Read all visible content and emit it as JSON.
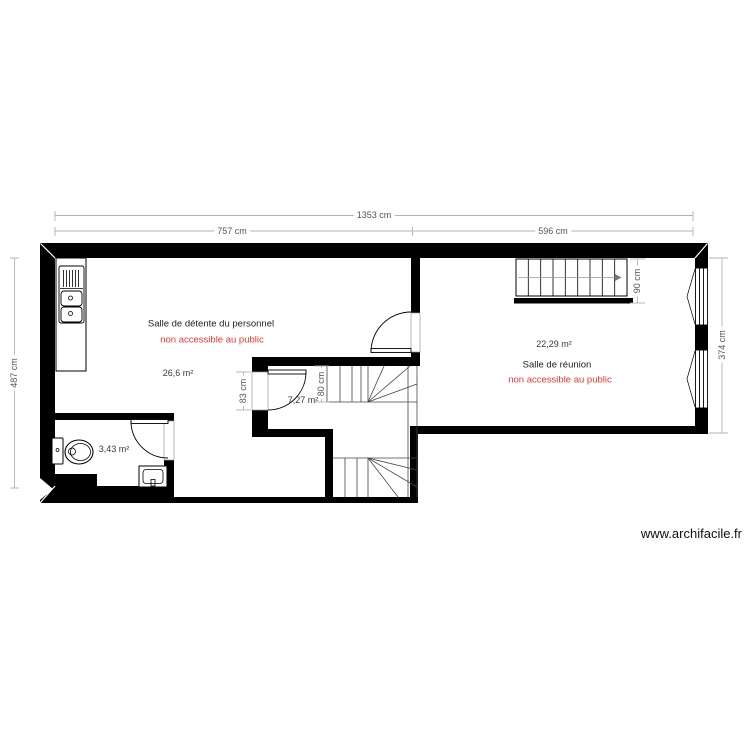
{
  "plan": {
    "watermark": "www.archifacile.fr",
    "rooms": [
      {
        "id": "salle-detente",
        "name": "Salle de détente du personnel",
        "restriction": "non accessible au public",
        "area": "26,6 m²"
      },
      {
        "id": "salle-reunion",
        "name": "Salle de réunion",
        "restriction": "non accessible au public",
        "area": "22,29 m²"
      },
      {
        "id": "hall-escalier",
        "name": "",
        "restriction": "",
        "area": "7,27 m²"
      },
      {
        "id": "wc",
        "name": "",
        "restriction": "",
        "area": "3,43 m²"
      }
    ],
    "dimensions": {
      "overall_width": "1353 cm",
      "detente_width": "757 cm",
      "reunion_width": "596 cm",
      "left_height": "487 cm",
      "reunion_height": "374 cm",
      "hall_door_height": "83 cm",
      "hall_stair_width": "80 cm",
      "reunion_stair_width": "90 cm"
    },
    "colors": {
      "wall": "#000000",
      "restriction_text": "#e8362e",
      "dimension_text": "#555555"
    }
  }
}
